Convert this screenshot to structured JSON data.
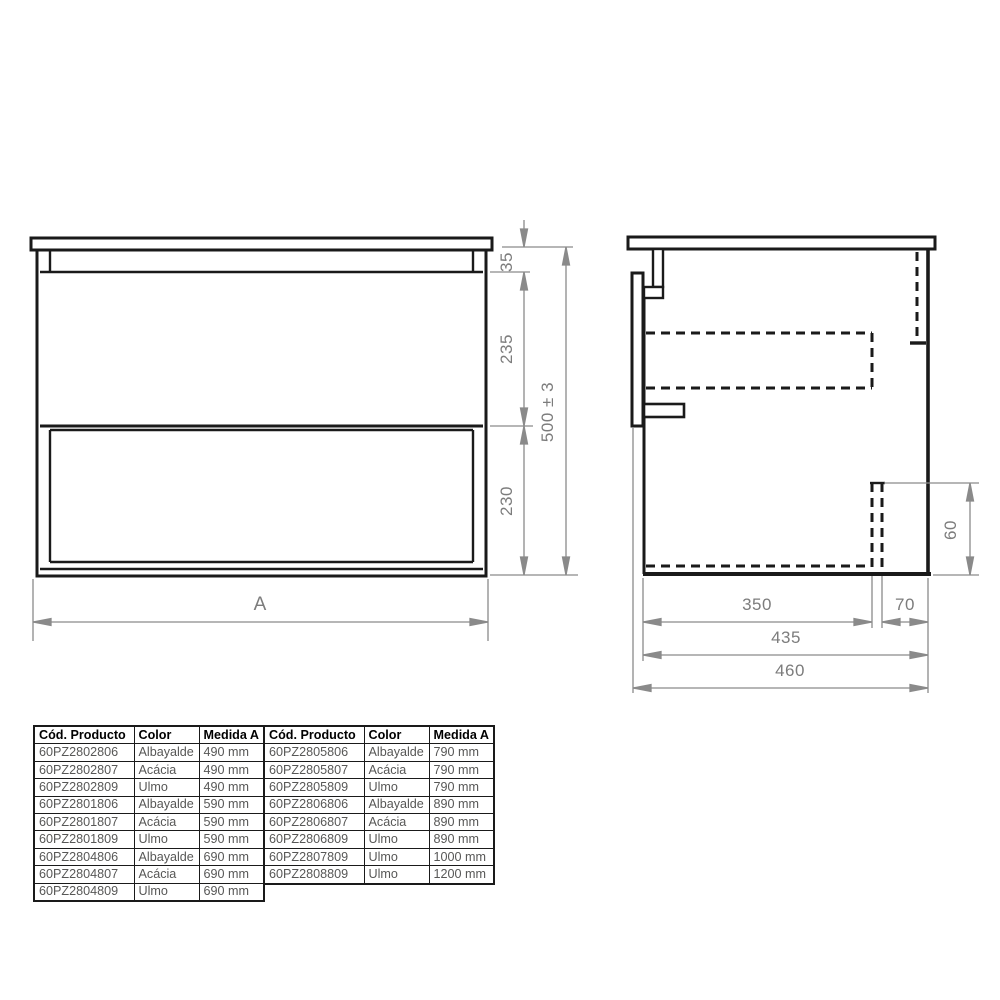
{
  "front_view": {
    "dim_top_rail": "35",
    "dim_upper_drawer": "235",
    "dim_lower_drawer": "230",
    "dim_total_height": "500 ± 3",
    "dim_width": "A"
  },
  "side_view": {
    "dim_bracket_height": "60",
    "dim_inner_depth": "350",
    "dim_back_offset": "70",
    "dim_carcass_depth": "435",
    "dim_total_depth": "460"
  },
  "tables": {
    "left": {
      "headers": [
        "Cód. Producto",
        "Color",
        "Medida A"
      ],
      "rows": [
        [
          "60PZ2802806",
          "Albayalde",
          "490 mm"
        ],
        [
          "60PZ2802807",
          "Acácia",
          "490 mm"
        ],
        [
          "60PZ2802809",
          "Ulmo",
          "490 mm"
        ],
        [
          "60PZ2801806",
          "Albayalde",
          "590 mm"
        ],
        [
          "60PZ2801807",
          "Acácia",
          "590 mm"
        ],
        [
          "60PZ2801809",
          "Ulmo",
          "590 mm"
        ],
        [
          "60PZ2804806",
          "Albayalde",
          "690 mm"
        ],
        [
          "60PZ2804807",
          "Acácia",
          "690 mm"
        ],
        [
          "60PZ2804809",
          "Ulmo",
          "690 mm"
        ]
      ]
    },
    "right": {
      "headers": [
        "Cód. Producto",
        "Color",
        "Medida A"
      ],
      "rows": [
        [
          "60PZ2805806",
          "Albayalde",
          "790 mm"
        ],
        [
          "60PZ2805807",
          "Acácia",
          "790 mm"
        ],
        [
          "60PZ2805809",
          "Ulmo",
          "790 mm"
        ],
        [
          "60PZ2806806",
          "Albayalde",
          "890 mm"
        ],
        [
          "60PZ2806807",
          "Acácia",
          "890 mm"
        ],
        [
          "60PZ2806809",
          "Ulmo",
          "890 mm"
        ],
        [
          "60PZ2807809",
          "Ulmo",
          "1000 mm"
        ],
        [
          "60PZ2808809",
          "Ulmo",
          "1200 mm"
        ]
      ]
    }
  },
  "colors": {
    "line": "#1a1a1a",
    "dimension": "#8a8a8a",
    "dimension_text": "#7c7c7c",
    "cell_text": "#575756"
  }
}
